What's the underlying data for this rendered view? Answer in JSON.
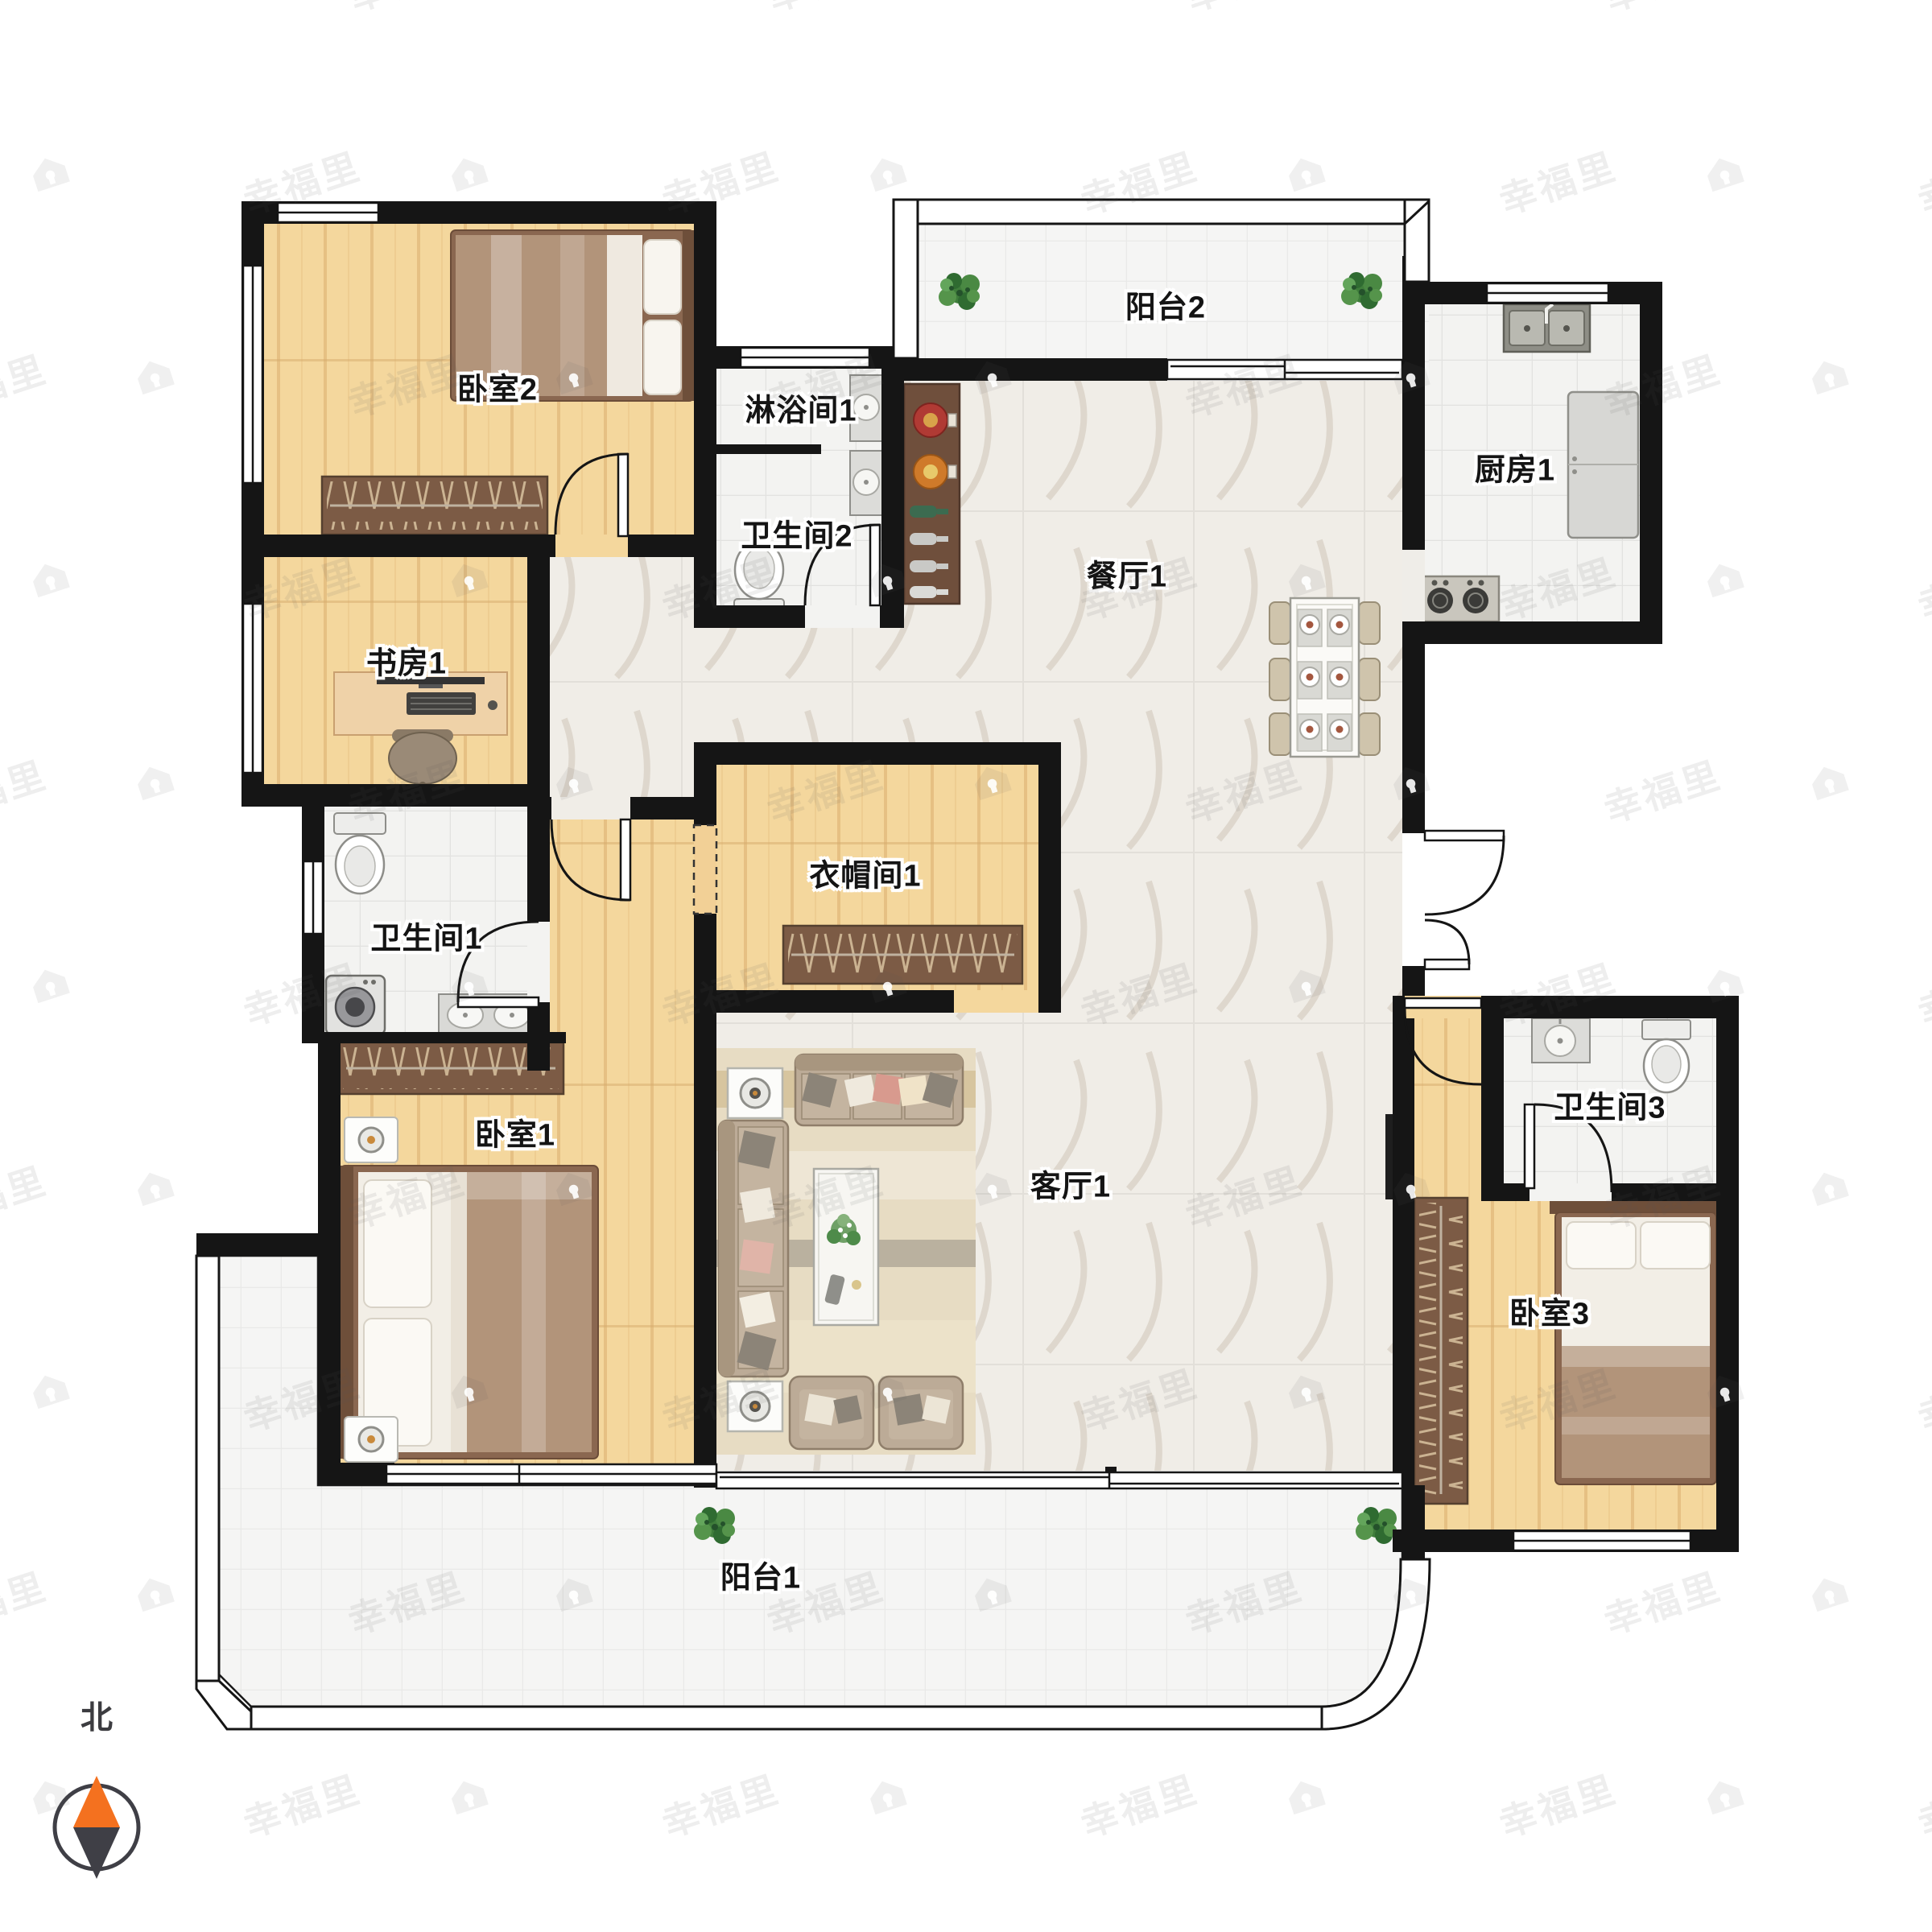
{
  "meta": {
    "title": "户型图 floor plan"
  },
  "compass": {
    "label": "北"
  },
  "watermark": {
    "text": "幸福里",
    "icon": "house-icon"
  },
  "colors": {
    "wall": "#151515",
    "wood_floor": "#F4D79D",
    "tile_floor": "#F3F3F1",
    "marble_floor": "#F0EDE7",
    "wardrobe": "#7C5B45",
    "bed_blanket": "#B2947A",
    "sofa": "#BCAB97",
    "compass_north": "#F4711F",
    "compass_south": "#3F3F46",
    "plant": "#3F7D3B"
  },
  "rooms": [
    {
      "id": "bedroom-2",
      "label": "卧室2"
    },
    {
      "id": "shower-1",
      "label": "淋浴间1"
    },
    {
      "id": "bathroom-2",
      "label": "卫生间2"
    },
    {
      "id": "balcony-2",
      "label": "阳台2"
    },
    {
      "id": "kitchen-1",
      "label": "厨房1"
    },
    {
      "id": "dining-1",
      "label": "餐厅1"
    },
    {
      "id": "study-1",
      "label": "书房1"
    },
    {
      "id": "bathroom-1",
      "label": "卫生间1"
    },
    {
      "id": "cloakroom-1",
      "label": "衣帽间1"
    },
    {
      "id": "living-1",
      "label": "客厅1"
    },
    {
      "id": "bedroom-1",
      "label": "卧室1"
    },
    {
      "id": "bathroom-3",
      "label": "卫生间3"
    },
    {
      "id": "bedroom-3",
      "label": "卧室3"
    },
    {
      "id": "balcony-1",
      "label": "阳台1"
    }
  ]
}
